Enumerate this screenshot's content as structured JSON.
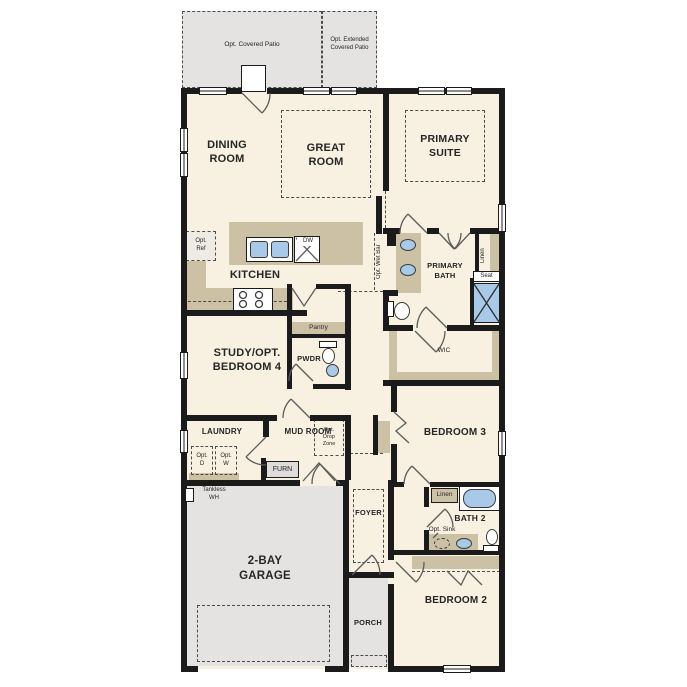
{
  "colors": {
    "wall": "#1b1b1b",
    "cream": "#f8f1e1",
    "tan": "#cdc1a5",
    "gray": "#e4e3e2",
    "blue": "#a9c9e8",
    "dashline": "#4c4c4c"
  },
  "labels": {
    "opt_covered_patio": "Opt. Covered Patio",
    "opt_extended_patio": "Opt. Extended\nCovered Patio",
    "dining": "DINING\nROOM",
    "great": "GREAT\nROOM",
    "primary_suite": "PRIMARY\nSUITE",
    "kitchen": "KITCHEN",
    "opt_ref": "Opt.\nRef",
    "opt_wet_bar": "Opt. Wet Bar",
    "dw": "DW",
    "pantry": "Pantry",
    "pwdr": "PWDR",
    "primary_bath": "PRIMARY\nBATH",
    "linen_primary": "Linen",
    "seat": "Seat",
    "wic": "WIC",
    "study": "STUDY/OPT.\nBEDROOM 4",
    "laundry": "LAUNDRY",
    "opt_d": "Opt.\nD",
    "opt_w": "Opt.\nW",
    "mud_room": "MUD ROOM",
    "opt_drop_zone": "Opt.\nDrop\nZone",
    "furn": "FURN",
    "tankless_wh": "Tankless\nWH",
    "garage": "2-BAY\nGARAGE",
    "foyer": "FOYER",
    "porch": "PORCH",
    "bedroom3": "BEDROOM 3",
    "linen_bath2": "Linen",
    "bath2": "BATH 2",
    "opt_sink": "Opt. Sink",
    "bedroom2": "BEDROOM 2"
  }
}
